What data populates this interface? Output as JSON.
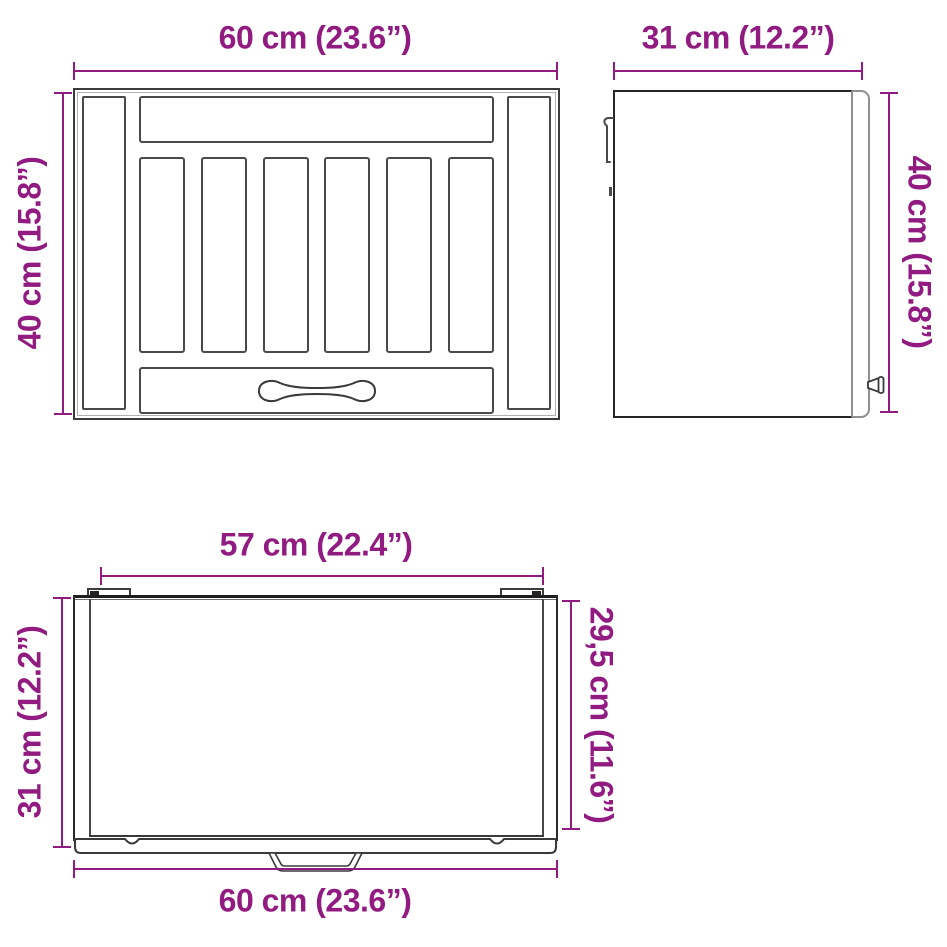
{
  "diagram": {
    "type": "furniture-dimension-drawing",
    "subject": "wall-cabinet"
  },
  "colors": {
    "dimension_text": "#911B81",
    "drawing_line": "#2E2E2E",
    "background": "#FFFFFF"
  },
  "front_view": {
    "width_label": "60 cm (23.6”)",
    "height_label": "40 cm (15.8”)"
  },
  "side_view": {
    "depth_label": "31 cm (12.2”)",
    "height_label": "40 cm (15.8”)"
  },
  "top_view": {
    "inner_width_label": "57 cm (22.4”)",
    "depth_label": "31 cm (12.2”)",
    "inner_depth_label": "29,5 cm (11.6”)",
    "width_label": "60 cm (23.6”)"
  }
}
